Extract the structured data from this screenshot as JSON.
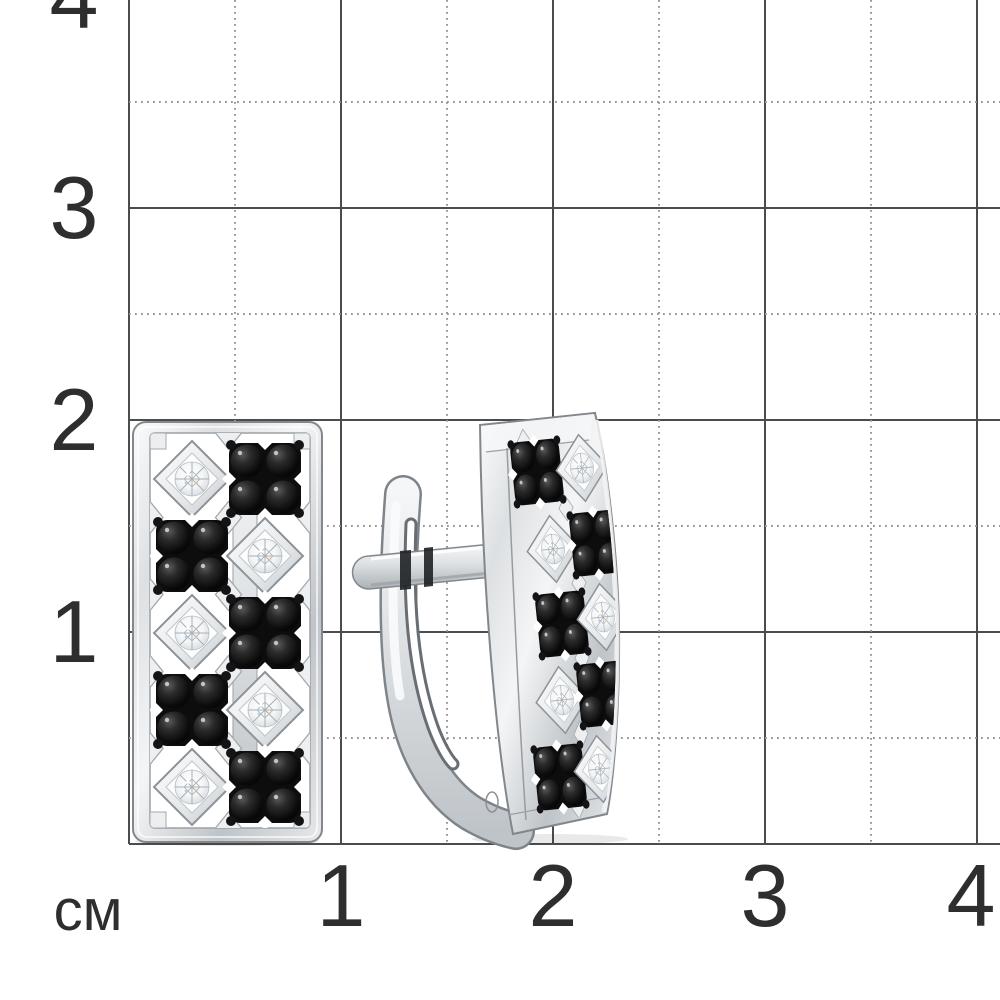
{
  "scene": {
    "background_color": "#ffffff",
    "description": "Pair of white-metal earrings with a checkerboard pattern of black stone clusters and bezel-set white diamonds, photographed over a centimeter measuring grid"
  },
  "ruler": {
    "unit_label": "см",
    "y_axis_labels": [
      "4",
      "3",
      "2",
      "1"
    ],
    "x_axis_labels": [
      "1",
      "2",
      "3",
      "4"
    ],
    "grid": {
      "solid_line_color": "#4c4c4c",
      "dotted_line_color": "#979797",
      "label_color": "#2e2e2e",
      "cm_spacing_px": 212
    }
  },
  "product": {
    "item": "pair of earrings with english lock clasp",
    "metal_color": "#d8dbde",
    "black_stone_color": "#0c0c0c",
    "white_stone_color": "#f3f5f6",
    "left_earring": {
      "view": "front",
      "rows": 5,
      "columns": 2,
      "cell_pattern": [
        [
          "white",
          "black"
        ],
        [
          "black",
          "white"
        ],
        [
          "white",
          "black"
        ],
        [
          "black",
          "white"
        ],
        [
          "white",
          "black"
        ]
      ],
      "black_stones_per_cluster": 4
    },
    "right_earring": {
      "view": "three-quarter",
      "rows": 5,
      "columns": 2,
      "cell_pattern": [
        [
          "black",
          "white"
        ],
        [
          "white",
          "black"
        ],
        [
          "black",
          "white"
        ],
        [
          "white",
          "black"
        ],
        [
          "black",
          "white"
        ]
      ],
      "black_stones_per_cluster": 4
    }
  }
}
